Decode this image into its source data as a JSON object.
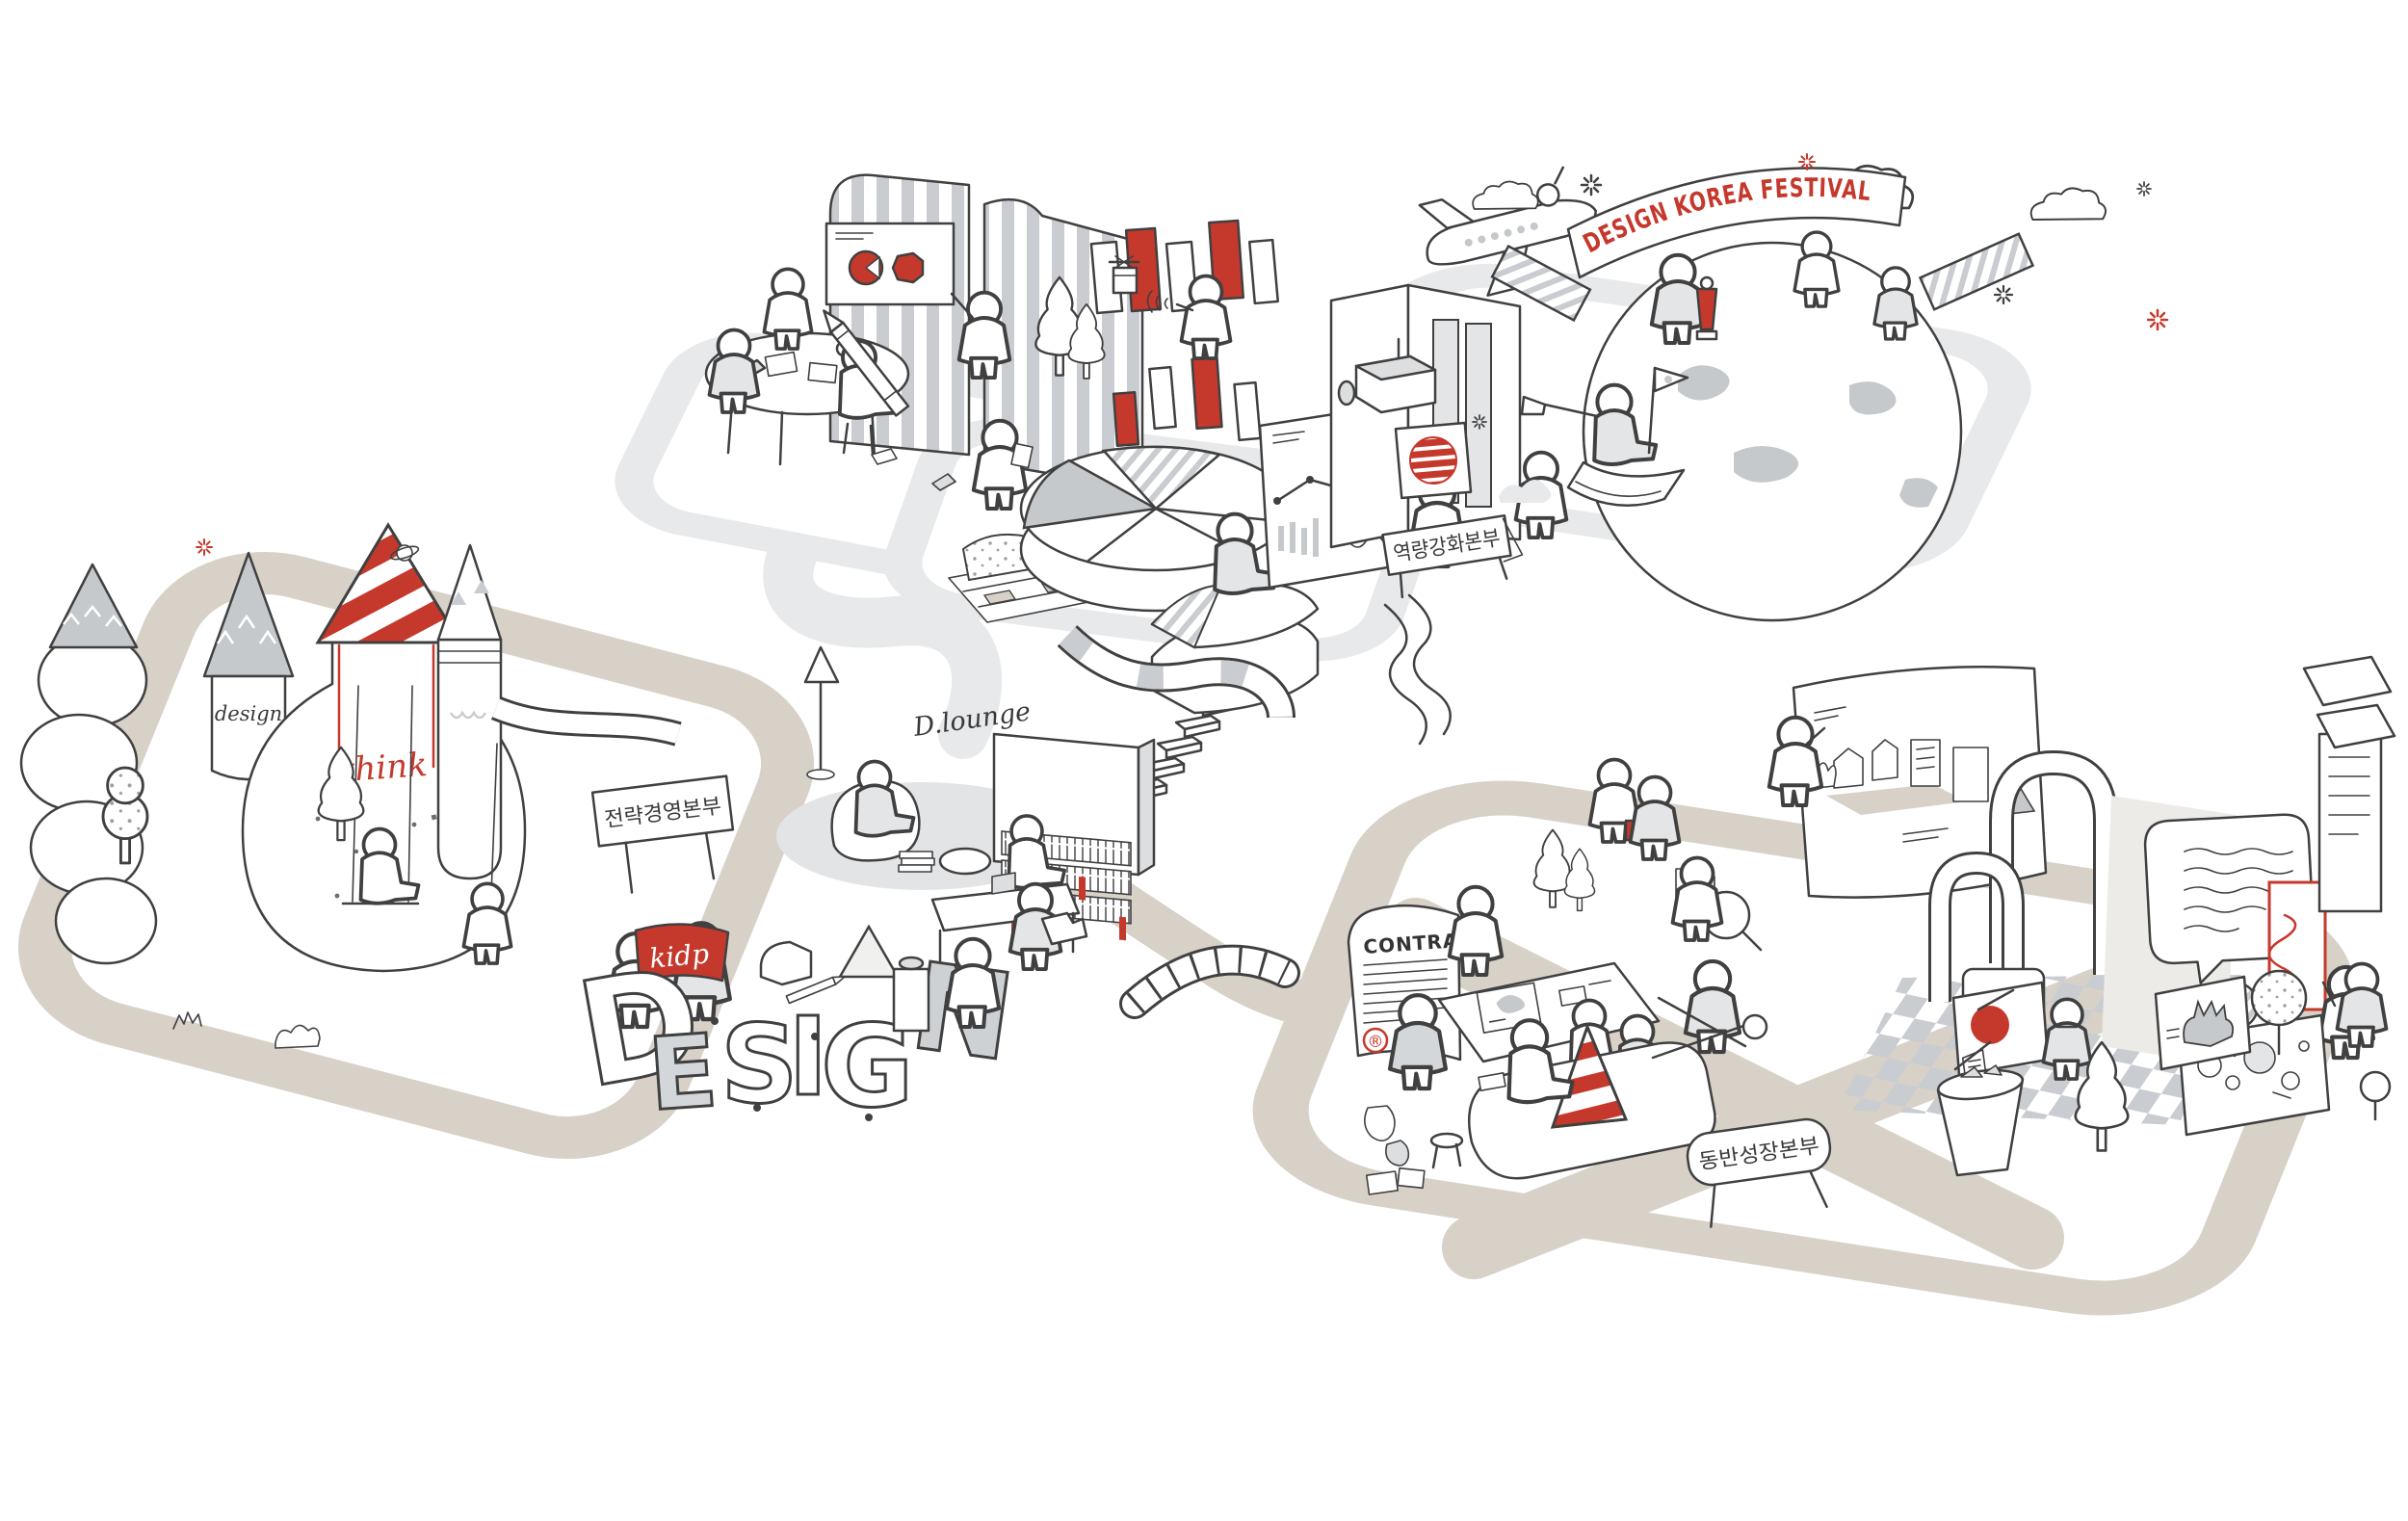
{
  "colors": {
    "accent_red": "#c5392d",
    "path_beige": "#d8d1c8",
    "platform_gray": "#e8e9ea",
    "ink": "#404040"
  },
  "scenes": {
    "festival": {
      "banner_text": "DESIGN KOREA FESTIVAL",
      "sign_text": "역량강화본부"
    },
    "strategy": {
      "sign_text": "전략경영본부",
      "lounge_text": "D.lounge",
      "flag_text": "kidp",
      "think_text": "think",
      "tower_script_text": "design",
      "letters": [
        "D",
        "E",
        "S",
        "I",
        "G",
        "N"
      ]
    },
    "growth": {
      "sign_text": "동반성장본부",
      "contract_title": "CONTRACT",
      "registered_symbol": "®"
    }
  }
}
